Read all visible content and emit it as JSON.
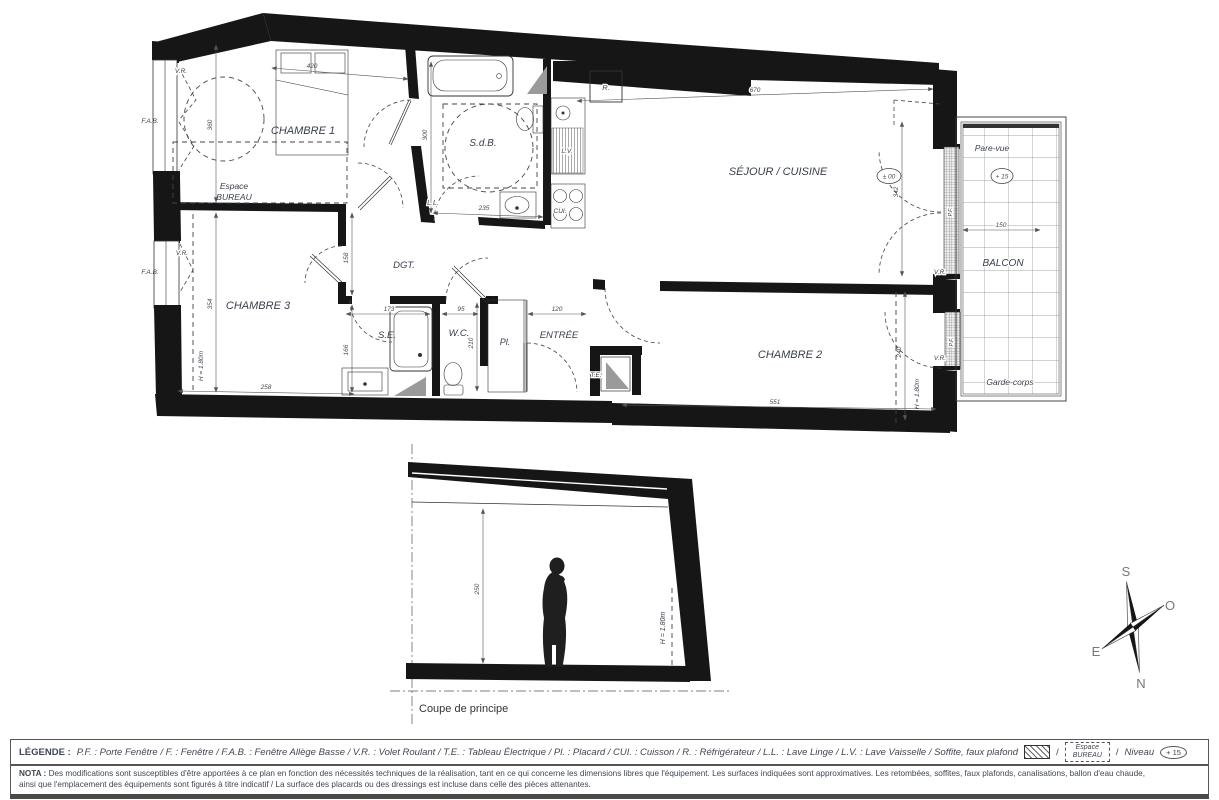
{
  "plan": {
    "rooms": {
      "chambre1": "CHAMBRE 1",
      "chambre2": "CHAMBRE 2",
      "chambre3": "CHAMBRE 3",
      "sejour_cuisine": "SÉJOUR / CUISINE",
      "sdb": "S.d.B.",
      "se": "S.E.",
      "wc": "W.C.",
      "dgt": "DGT.",
      "entree": "ENTRÉE",
      "placard": "Pl.",
      "te": "T.E.",
      "espace_line1": "Espace",
      "espace_line2": "BUREAU",
      "balcon": "BALCON"
    },
    "equipment": {
      "refrigerateur": "R.",
      "lave_linge": "L.L.",
      "lave_vaisselle": "L.V.",
      "cuisson": "CUI."
    },
    "windows": {
      "vr": "V.R.",
      "fab": "F.A.B.",
      "pf": "P.F."
    },
    "balcony": {
      "pare_vue": "Pare-vue",
      "garde_corps": "Garde-corps",
      "niveau": "+ 15"
    },
    "levels": {
      "sejour": "± 00"
    },
    "heights": {
      "h180": "H = 1.80m"
    },
    "dims": {
      "d670": "670",
      "d420": "420",
      "d360": "360",
      "d354": "354",
      "d300": "300",
      "d235": "235",
      "d258": "258",
      "d158": "158",
      "d166": "166",
      "d173": "173",
      "d95": "95",
      "d210": "210",
      "d120": "120",
      "d551": "551",
      "d342": "342",
      "d240": "240",
      "d150": "150",
      "d250": "250"
    },
    "section": {
      "title": "Coupe de principe"
    },
    "compass": {
      "n": "N",
      "s": "S",
      "e": "E",
      "o": "O"
    }
  },
  "legend": {
    "label": "LÉGENDE :",
    "abbreviations": "P.F. : Porte Fenêtre / F. : Fenêtre / F.A.B. : Fenêtre Allège Basse / V.R. : Volet Roulant / T.E. : Tableau Électrique  / Pl. : Placard  / CUI. : Cuisson / R. : Réfrigérateur / L.L. : Lave Linge /  L.V. : Lave Vaisselle / Soffite, faux plafond",
    "separator": "/",
    "espace_bureau_line1": "Espace",
    "espace_bureau_line2": "BUREAU",
    "niveau_label": "Niveau",
    "niveau_value": "+ 15"
  },
  "nota": {
    "label": "NOTA :",
    "line1": "Des modifications sont susceptibles d'être apportées à ce plan en fonction des nécessités techniques de la réalisation, tant en ce qui concerne les dimensions libres que l'équipement. Les surfaces indiquées sont approximatives. Les retombées, soffites, faux plafonds, canalisations, ballon d'eau chaude,",
    "line2": "ainsi que l'emplacement des équipements sont figurés à titre indicatif / La surface des placards ou des dressings est incluse dans celle des pièces attenantes."
  },
  "colors": {
    "wall": "#161616",
    "line": "#333333",
    "label": "#39404e",
    "dimension": "#4a4a4a",
    "soffite_gray": "#9a9a9a"
  }
}
